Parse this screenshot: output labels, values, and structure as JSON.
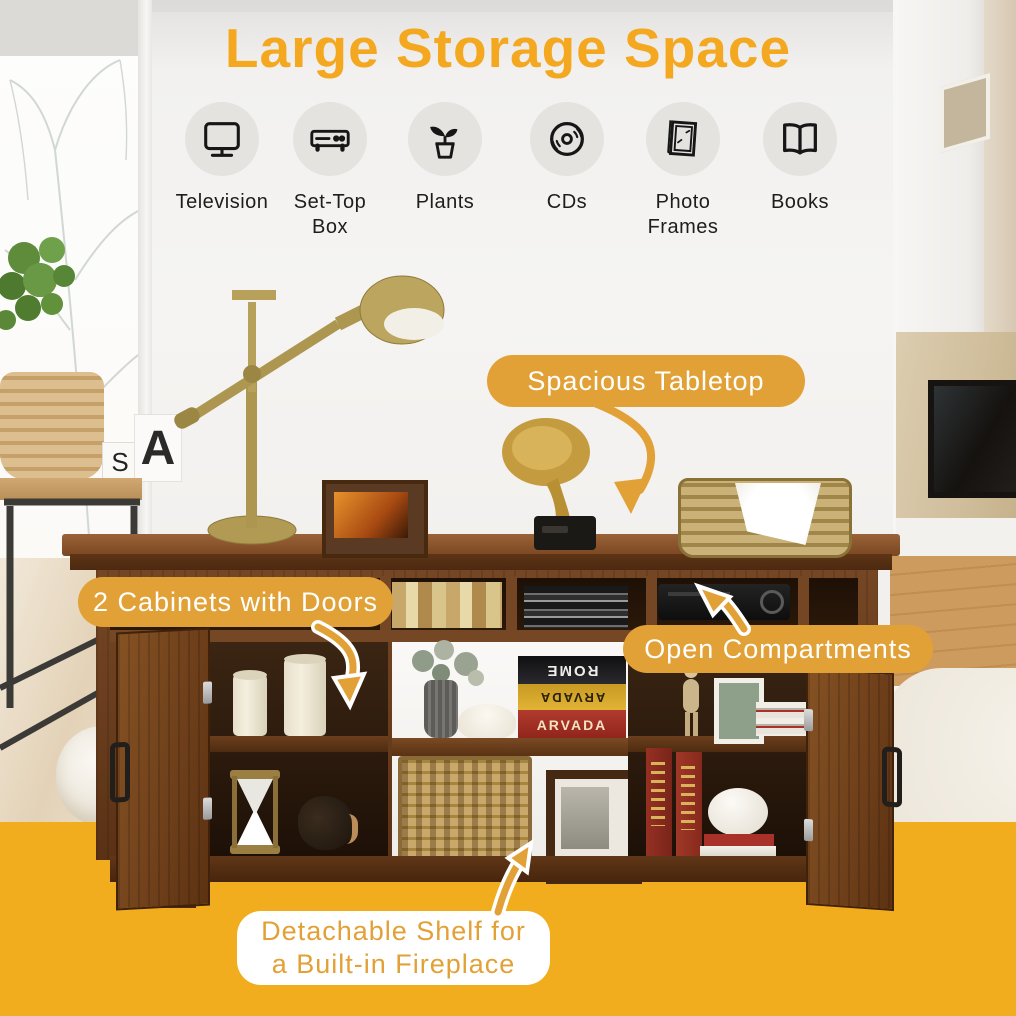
{
  "title": "Large Storage Space",
  "features": [
    {
      "label": "Television",
      "icon": "television-icon"
    },
    {
      "label": "Set-Top Box",
      "icon": "set-top-box-icon"
    },
    {
      "label": "Plants",
      "icon": "plant-icon"
    },
    {
      "label": "CDs",
      "icon": "cd-icon"
    },
    {
      "label": "Photo Frames",
      "icon": "photo-frame-icon"
    },
    {
      "label": "Books",
      "icon": "book-icon"
    }
  ],
  "callouts": {
    "spacious_tabletop": "Spacious Tabletop",
    "cabinets": "2 Cabinets with Doors",
    "open_compartments": "Open Compartments",
    "detachable_shelf": {
      "line1": "Detachable Shelf for",
      "line2": "a Built-in Fireplace"
    }
  },
  "photo_text": {
    "book_spine_top": "ROME",
    "book_spine_middle": "ARVADA",
    "book_spine_bottom": "ARVADA",
    "mug_letters": [
      "S",
      "A"
    ]
  },
  "colors": {
    "title": "#F4A820",
    "callout_bg": "#E2A136",
    "callout_text": "#FFFFFF",
    "bottom_band": "#F2AD1F",
    "icon_circle": "#E5E3E0",
    "icon_stroke": "#161616"
  }
}
